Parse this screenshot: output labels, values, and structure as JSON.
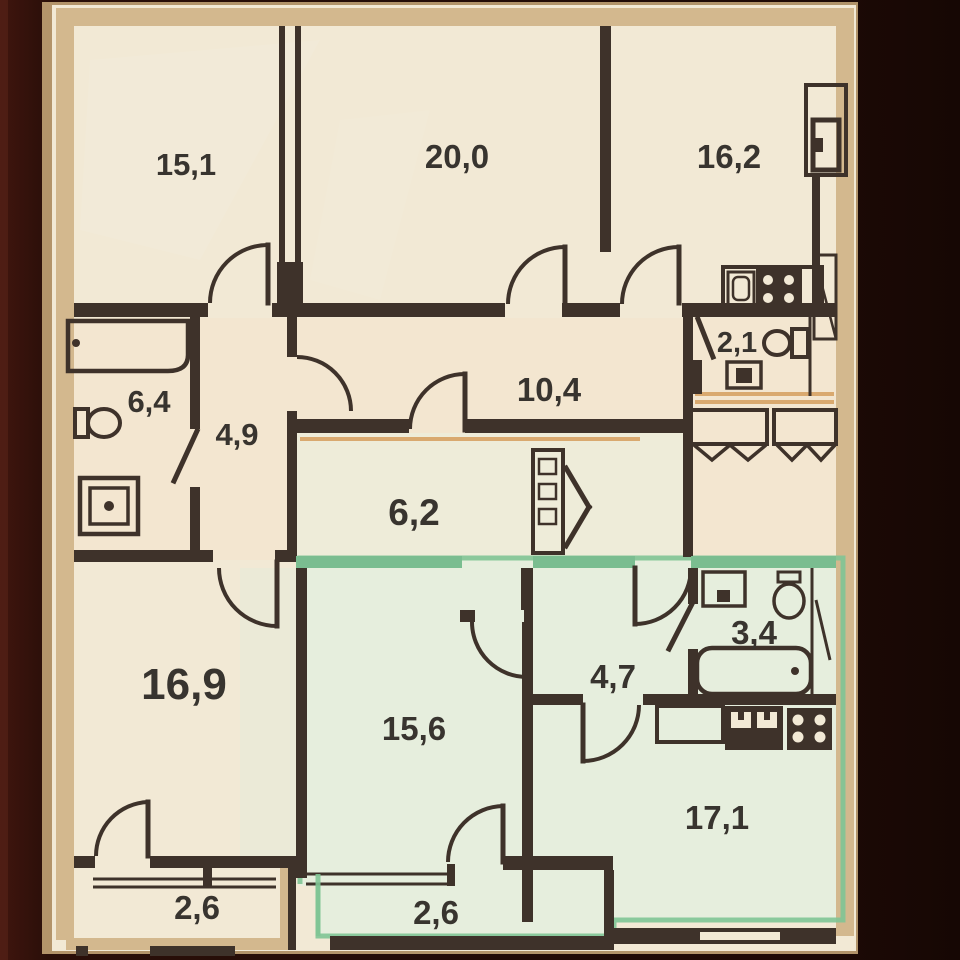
{
  "plan": {
    "kind": "apartment-floor-plan-photo",
    "decimal_style": "comma",
    "highlighted_unit": "bottom apartment outlined in green",
    "fixtures": [
      "bathtub",
      "toilet",
      "washing-machine",
      "sink",
      "stove-4-burner",
      "kitchen-counter",
      "wardrobe-hatched",
      "shelf-closet",
      "duct-shaft"
    ]
  },
  "rooms": [
    {
      "id": "room-15-1",
      "area": "15,1"
    },
    {
      "id": "room-20-0",
      "area": "20,0"
    },
    {
      "id": "room-16-2",
      "area": "16,2"
    },
    {
      "id": "room-6-4",
      "area": "6,4"
    },
    {
      "id": "room-4-9",
      "area": "4,9"
    },
    {
      "id": "room-10-4",
      "area": "10,4"
    },
    {
      "id": "room-2-1",
      "area": "2,1"
    },
    {
      "id": "room-6-2",
      "area": "6,2"
    },
    {
      "id": "room-16-9",
      "area": "16,9"
    },
    {
      "id": "room-15-6",
      "area": "15,6"
    },
    {
      "id": "room-4-7",
      "area": "4,7"
    },
    {
      "id": "room-3-4",
      "area": "3,4"
    },
    {
      "id": "room-17-1",
      "area": "17,1"
    },
    {
      "id": "balcony-left",
      "area": "2,6"
    },
    {
      "id": "balcony-mid",
      "area": "2,6"
    }
  ],
  "colors": {
    "photo_background": "#1d0b07",
    "paper": "#f2e9d5",
    "exterior_wall": "#d3b88e",
    "interior_wall": "#3e322a",
    "highlight_green": "#7abd90",
    "mint_fill": "#e6eedd",
    "threshold_tan": "#d9a96f",
    "label_text": "#38342f"
  }
}
